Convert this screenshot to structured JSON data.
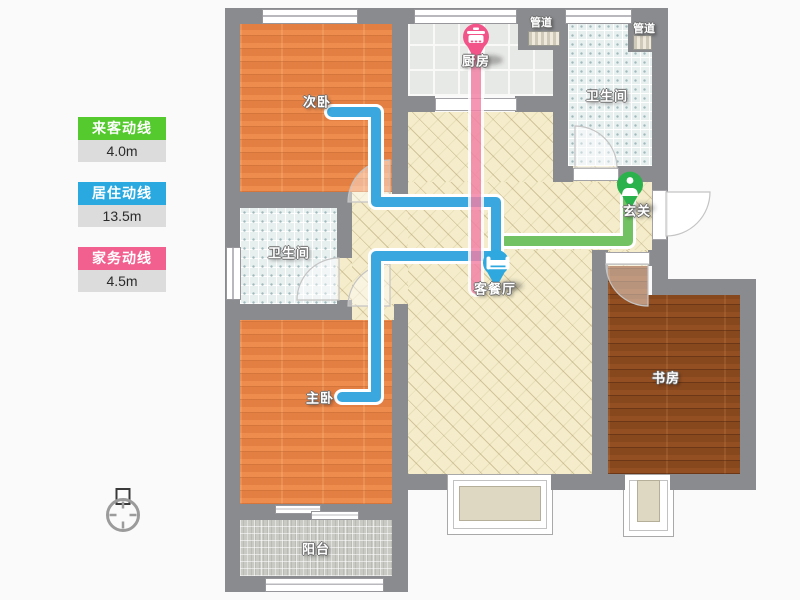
{
  "title": "户型动线图",
  "legend": {
    "items": [
      {
        "id": "guest",
        "label": "来客动线",
        "value": "4.0m",
        "color": "#55ca2f"
      },
      {
        "id": "living",
        "label": "居住动线",
        "value": "13.5m",
        "color": "#29a9e0"
      },
      {
        "id": "chore",
        "label": "家务动线",
        "value": "4.5m",
        "color": "#f2608f"
      }
    ]
  },
  "rooms": {
    "bedroom2": "次卧",
    "kitchen": "厨房",
    "duct1": "管道",
    "duct2": "管道",
    "bath1": "卫生间",
    "bath2": "卫生间",
    "entry": "玄关",
    "living": "客餐厅",
    "bedroom1": "主卧",
    "study": "书房",
    "balcony": "阳台"
  },
  "routes": {
    "guest": {
      "color": "#72c263",
      "length": "4.0m"
    },
    "living": {
      "color": "#3aa8df",
      "length": "13.5m"
    },
    "chore": {
      "color": "#f37fa5",
      "length": "4.5m"
    }
  },
  "pins": {
    "kitchen": {
      "color": "#f2548a",
      "icon": "pot-icon"
    },
    "living": {
      "color": "#2fa8e0",
      "icon": "sofa-icon"
    },
    "entry": {
      "color": "#2bb24c",
      "icon": "person-icon"
    }
  },
  "colors": {
    "wall": "#8a8b8e",
    "livingFloor": "#f4ecca",
    "bedroomFloor": "#e98448",
    "studyFloor": "#87481e"
  }
}
